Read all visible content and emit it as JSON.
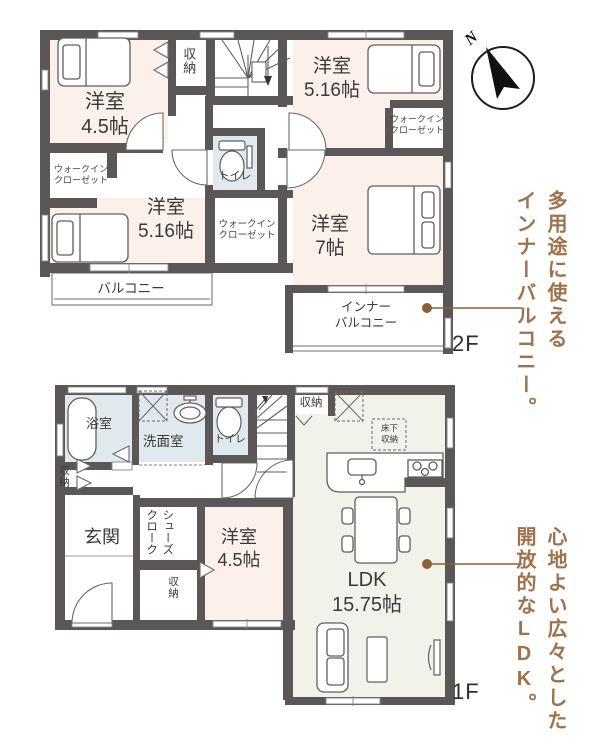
{
  "floor2": {
    "label": "2F",
    "bedroom45": "洋室\n4.5帖",
    "closet": "収納",
    "bedroom516a": "洋室\n5.16帖",
    "wic_right": "ウォークイン\nクローゼット",
    "toilet": "トイレ",
    "wic_left": "ウォークイン\nクローゼット",
    "bedroom516b": "洋室\n5.16帖",
    "wic_center": "ウォークイン\nクローゼット",
    "bedroom7": "洋室\n7帖",
    "balcony": "バルコニー",
    "inner_balcony": "インナー\nバルコニー",
    "annotation": "多用途に使える\nインナーバルコニー。",
    "compass_n": "N"
  },
  "floor1": {
    "label": "1F",
    "bath": "浴室",
    "washroom": "洗面室",
    "toilet": "トイレ",
    "closet_top": "収納",
    "underfloor_storage": "床下\n収納",
    "closet_left": "収納",
    "entrance": "玄関",
    "shoes_closet": "シューズクローク",
    "bedroom45": "洋室\n4.5帖",
    "closet_mid": "収納",
    "ldk": "LDK\n15.75帖",
    "annotation": "心地よい広々とした\n開放的なLDK。"
  },
  "colors": {
    "wall": "#5a5756",
    "room_cream": "#fbf0ea",
    "wet_blue": "#dfe9ee",
    "ldk_green": "#f1f2ea",
    "accent_brown": "#a0714a"
  }
}
